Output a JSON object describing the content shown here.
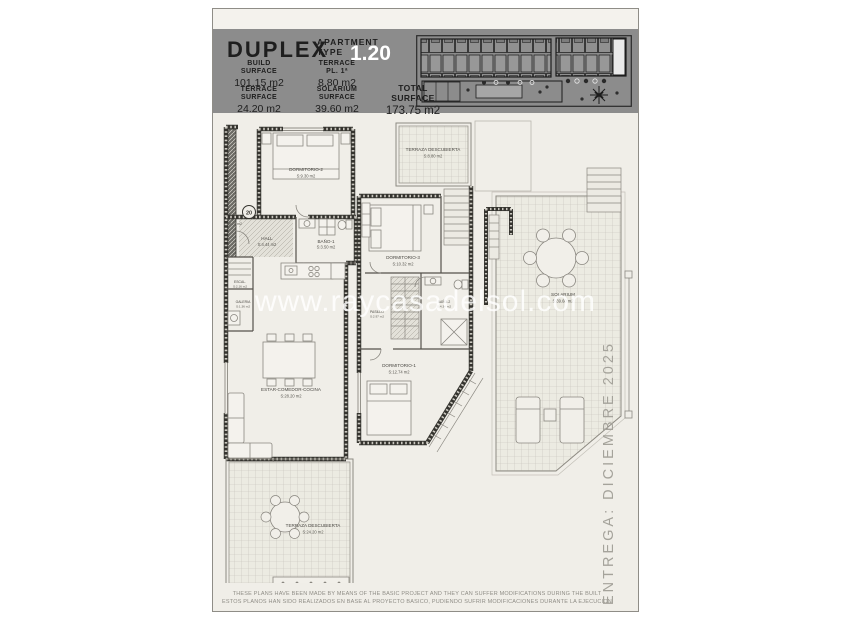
{
  "header": {
    "title": "DUPLEX",
    "subtitle_line1": "APARTMENT",
    "subtitle_line2": "TYPE",
    "type_number": "1.20",
    "surfaces": [
      {
        "l1": "BUILD",
        "l2": "SURFACE",
        "value": "101.15 m2"
      },
      {
        "l1": "TERRACE",
        "l2": "PL. 1ª",
        "value": "8.80 m2"
      },
      {
        "l1": "TERRACE",
        "l2": "SURFACE",
        "value": "24.20 m2"
      },
      {
        "l1": "SOLARIUM",
        "l2": "SURFACE",
        "value": "39.60 m2"
      },
      {
        "l1": "TOTAL",
        "l2": "SURFACE",
        "value": "173.75 m2"
      }
    ]
  },
  "plan": {
    "unit_badge": "20",
    "unit_area": "78.79 m2",
    "rooms": {
      "dormitorio2": {
        "name": "DORMITORIO-2",
        "area": "S:9.30 m2"
      },
      "hall": {
        "name": "HALL",
        "area": "S:4.44 m2"
      },
      "bano1": {
        "name": "BAÑO-1",
        "area": "S:3.50 m2"
      },
      "escalera": {
        "name": "ESCAL.",
        "area": "S:2.16 m2"
      },
      "galeria": {
        "name": "GALERIA",
        "area": "S:1.36 m2"
      },
      "estar": {
        "name": "ESTAR-COMEDOR-COCINA",
        "area": "S:28.20 m2"
      },
      "terraza_pb": {
        "name": "TERRAZA DESCUBIERTA",
        "area": "S:24.20 m2"
      },
      "terraza_p1": {
        "name": "TERRAZA DESCUBIERTA",
        "area": "S:8.80 m2"
      },
      "dormitorio3": {
        "name": "DORMITORIO-3",
        "area": "S:10.32 m2"
      },
      "pasillo": {
        "name": "PASILLO",
        "area": "S:2.97 m2"
      },
      "bano2": {
        "name": "BAÑO-2",
        "area": "S:4.34 m2"
      },
      "dormitorio1": {
        "name": "DORMITORIO-1",
        "area": "S:12.74 m2"
      },
      "solarium": {
        "name": "SOLARIUM",
        "area": "S:39.60 m2"
      }
    }
  },
  "watermark": "www.raycasadelsol.com",
  "side_note": "ENTREGA: DICIEMBRE 2025",
  "footer": {
    "line1": "THESE PLANS HAVE BEEN MADE BY MEANS OF THE BASIC PROJECT AND THEY CAN SUFFER MODIFICATIONS DURING THE BUILT",
    "line2": "ESTOS PLANOS HAN SIDO REALIZADOS EN BASE AL PROYECTO BASICO, PUDIENDO SUFRIR MODIFICACIONES DURANTE LA EJECUCION"
  },
  "colors": {
    "header_band": "#8c8c8c",
    "sheet_background": "#f0eee8",
    "wall": "#35342f",
    "highlight_unit": "#eaeaea"
  }
}
